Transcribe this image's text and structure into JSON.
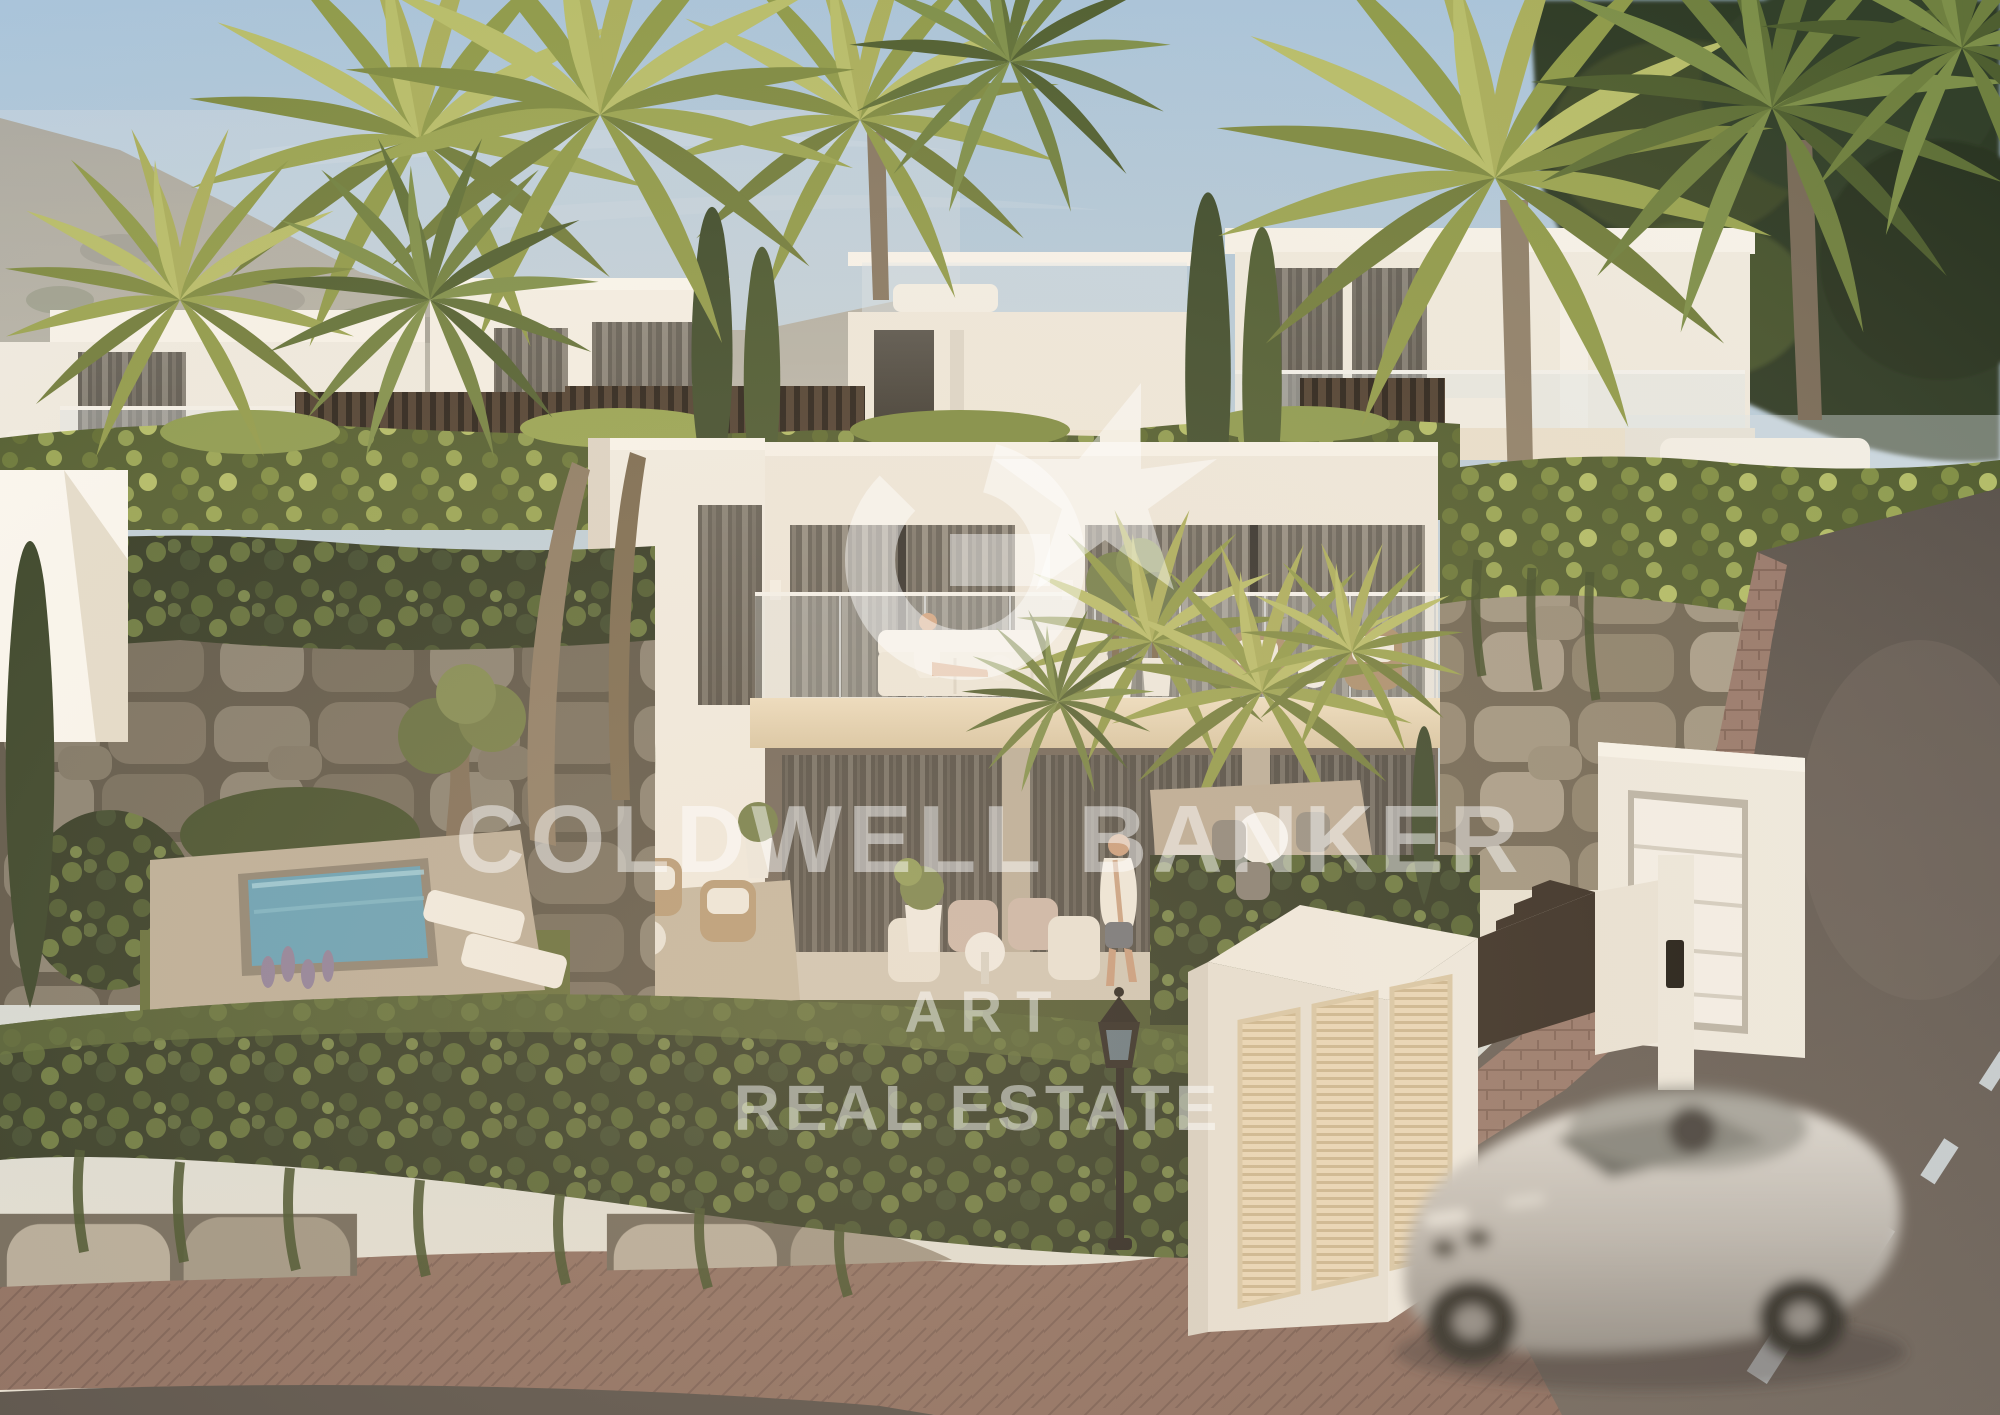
{
  "meta": {
    "type": "architectural-exterior-render",
    "subject": "modern hillside villas with palm trees, pool, street and passing car",
    "width_px": 2000,
    "height_px": 1415
  },
  "watermark": {
    "logo": "coldwell-banker-cb-star-seal",
    "line1": "COLDWELL BANKER",
    "line2": "ART",
    "line3": "REAL ESTATE",
    "color": "#ffffff",
    "opacity": 0.48
  },
  "palette": {
    "sky_top": "#a9c4da",
    "sky_horizon": "#e7e2d6",
    "villa_white": "#f1ede3",
    "fascia_cream": "#e7d9bd",
    "window_dark": "#3e3d3b",
    "stone_wall": "#a79f90",
    "hedge_green": "#2b351f",
    "palm_gold": "#a8ad5e",
    "pool_water": "#5f9fb8",
    "road_asphalt": "#5a534d",
    "brick_paving": "#8d6e61",
    "car_silver": "#c0bdb7",
    "lamp_black": "#1f1d1a"
  }
}
